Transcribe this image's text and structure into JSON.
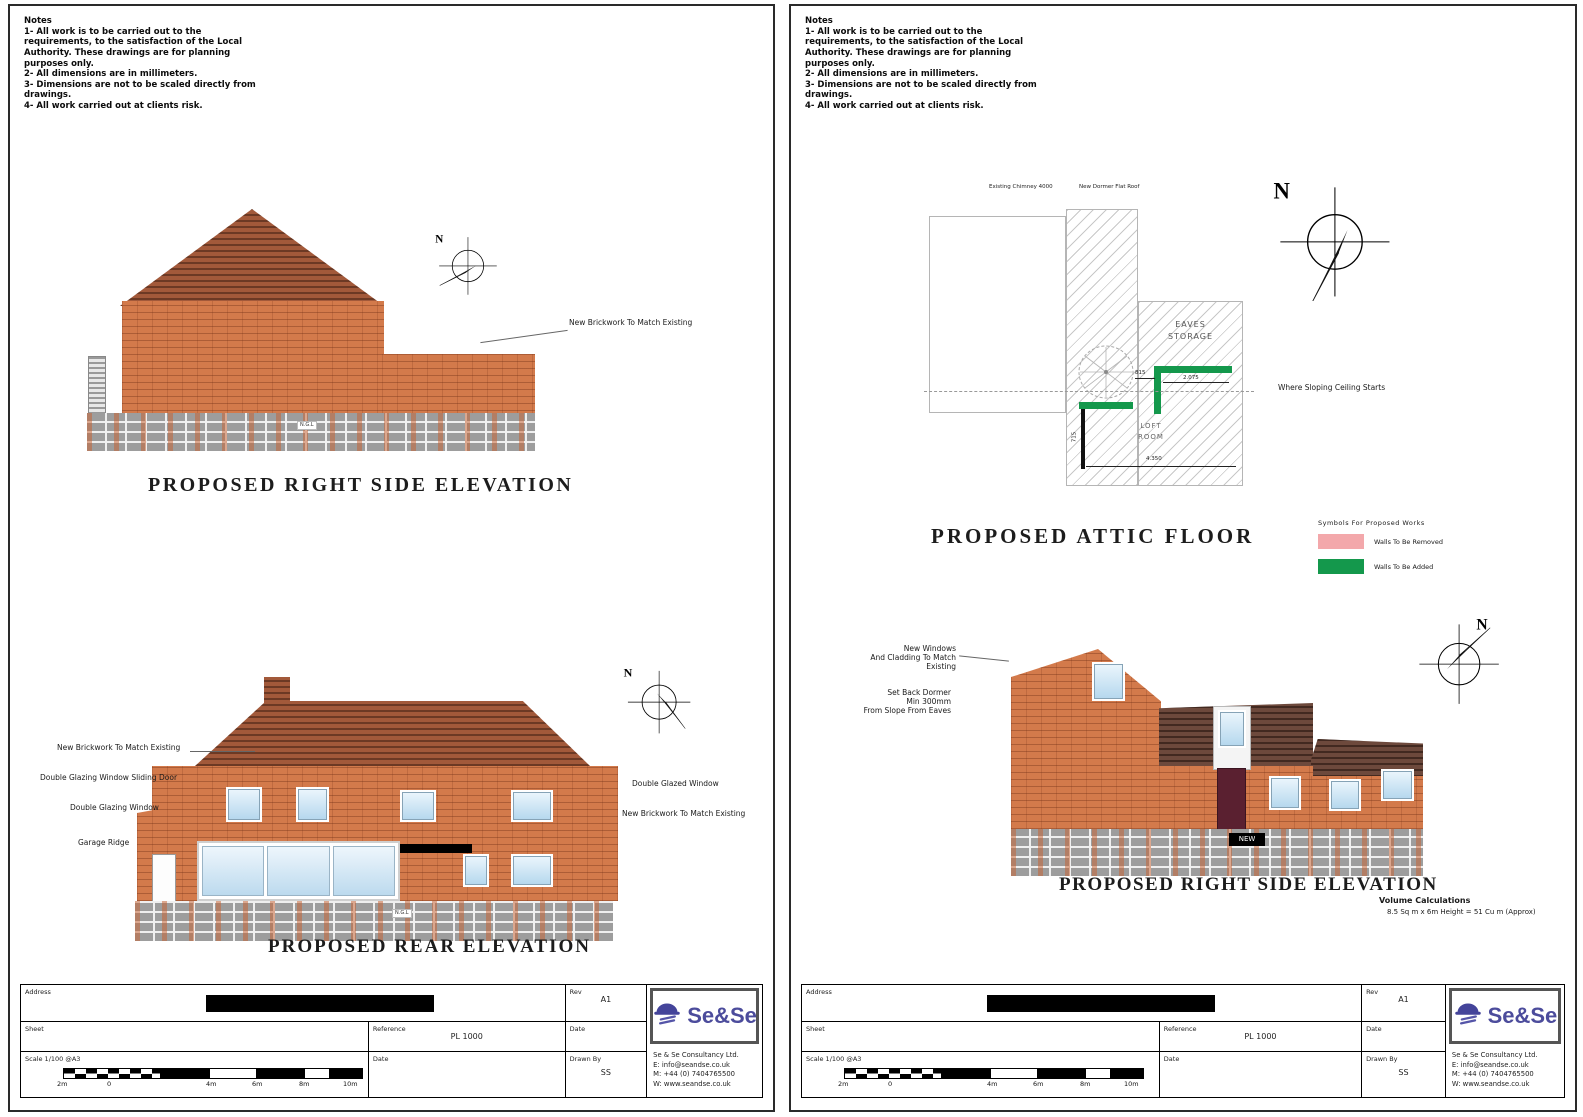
{
  "notes": {
    "title": "Notes",
    "lines": [
      "1- All work is to be carried out to the",
      "requirements, to the satisfaction of the Local",
      "Authority. These drawings are for planning",
      "purposes only.",
      "2- All dimensions are in millimeters.",
      "3- Dimensions are not to be scaled directly from",
      "drawings.",
      "4- All work carried out at clients risk."
    ]
  },
  "left_sheet": {
    "side_elevation": {
      "title": "PROPOSED RIGHT SIDE ELEVATION",
      "annotation": "New Brickwork To Match Existing",
      "ground_tag": "N.G.L"
    },
    "rear_elevation": {
      "title": "PROPOSED REAR ELEVATION",
      "ground_tag": "N.G.L",
      "labels_left": [
        "New Brickwork To Match Existing",
        "Double Glazing Window Sliding Door",
        "Double Glazing Window",
        "Garage Ridge"
      ],
      "labels_right": [
        "Double Glazed Window",
        "New Brickwork To Match Existing"
      ]
    }
  },
  "right_sheet": {
    "attic_plan": {
      "title": "PROPOSED ATTIC FLOOR",
      "eaves_line1": "EAVES",
      "eaves_line2": "STORAGE",
      "room_line1": "LOFT",
      "room_line2": "ROOM",
      "sloping_label": "Where Sloping Ceiling Starts",
      "dim_top_left": "Existing Chimney 4000",
      "dim_top_right": "New Dormer Flat Roof",
      "dim_green": "2.075",
      "dim_stair": "815",
      "dim_left": "715",
      "dim_bottom": "4.350"
    },
    "legend": {
      "title": "Symbols For Proposed Works",
      "removed_label": "Walls To Be Removed",
      "added_label": "Walls To Be Added",
      "removed_color": "#f3a8ab",
      "added_color": "#14984c"
    },
    "elevation": {
      "title": "PROPOSED RIGHT SIDE ELEVATION",
      "new_tag": "NEW",
      "annotation1": [
        "New Windows",
        "And Cladding To Match",
        "Existing"
      ],
      "annotation2": [
        "Set Back Dormer",
        "Min 300mm",
        "From Slope From Eaves"
      ],
      "volume_line1": "Volume Calculations",
      "volume_line2": "8.5 Sq m x 6m Height = 51 Cu m (Approx)"
    }
  },
  "titleblock": {
    "address_label": "Address",
    "sheet_label": "Sheet",
    "scale_label": "Scale 1/100  @A3",
    "reference_label": "Reference",
    "reference_value": "PL 1000",
    "date_label": "Date",
    "rev_label": "Rev",
    "rev_value": "A1",
    "date2_label": "Date",
    "drawn_label": "Drawn By",
    "drawn_value": "SS",
    "ticks": [
      "2m",
      "0",
      "4m",
      "6m",
      "8m",
      "10m"
    ],
    "logo": "Se&Se",
    "company": [
      "Se & Se Consultancy Ltd.",
      "E: info@seandse.co.uk",
      "M: +44 (0) 7404765500",
      "W: www.seandse.co.uk"
    ]
  },
  "compass": {
    "letter": "N"
  }
}
